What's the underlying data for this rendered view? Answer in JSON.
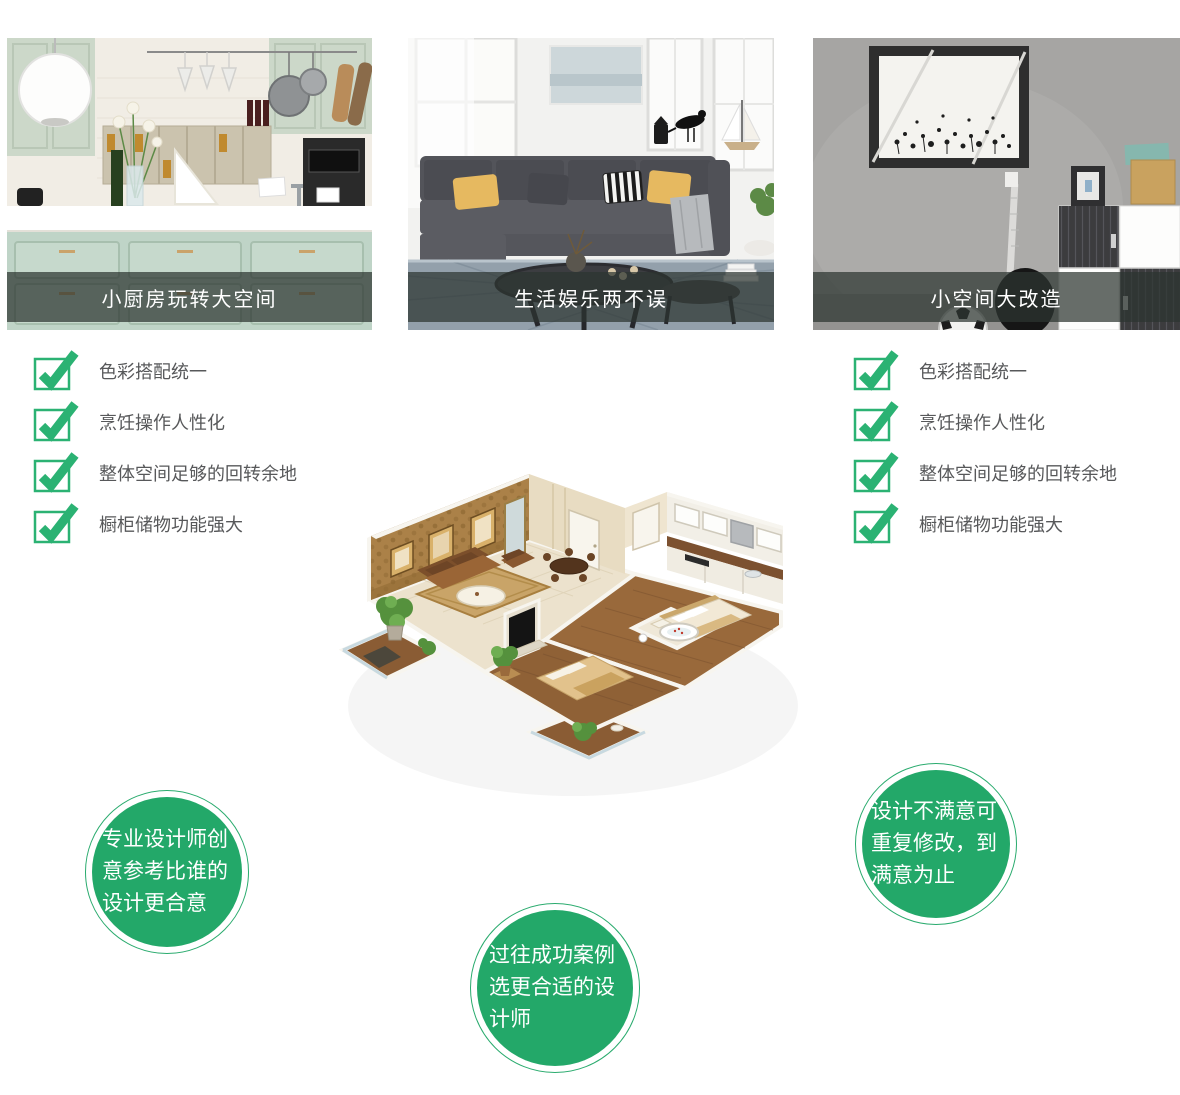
{
  "cards": [
    {
      "caption": "小厨房玩转大空间"
    },
    {
      "caption": "生活娱乐两不误"
    },
    {
      "caption": "小空间大改造"
    }
  ],
  "checklists": {
    "left": {
      "items": [
        "色彩搭配统一",
        "烹饪操作人性化",
        "整体空间足够的回转余地",
        "橱柜储物功能强大"
      ]
    },
    "right": {
      "items": [
        "色彩搭配统一",
        "烹饪操作人性化",
        "整体空间足够的回转余地",
        "橱柜储物功能强大"
      ]
    }
  },
  "bubbles": {
    "left": "专业设计师创意参考比谁的设计更合意",
    "middle": "过往成功案例选更合适的设计师",
    "right": "设计不满意可重复修改，到满意为止"
  },
  "colors": {
    "accent_green": "#23a869",
    "check_green": "#2bb273",
    "caption_overlay": "rgba(44,52,49,0.72)",
    "list_text_gray": "#57585a"
  }
}
